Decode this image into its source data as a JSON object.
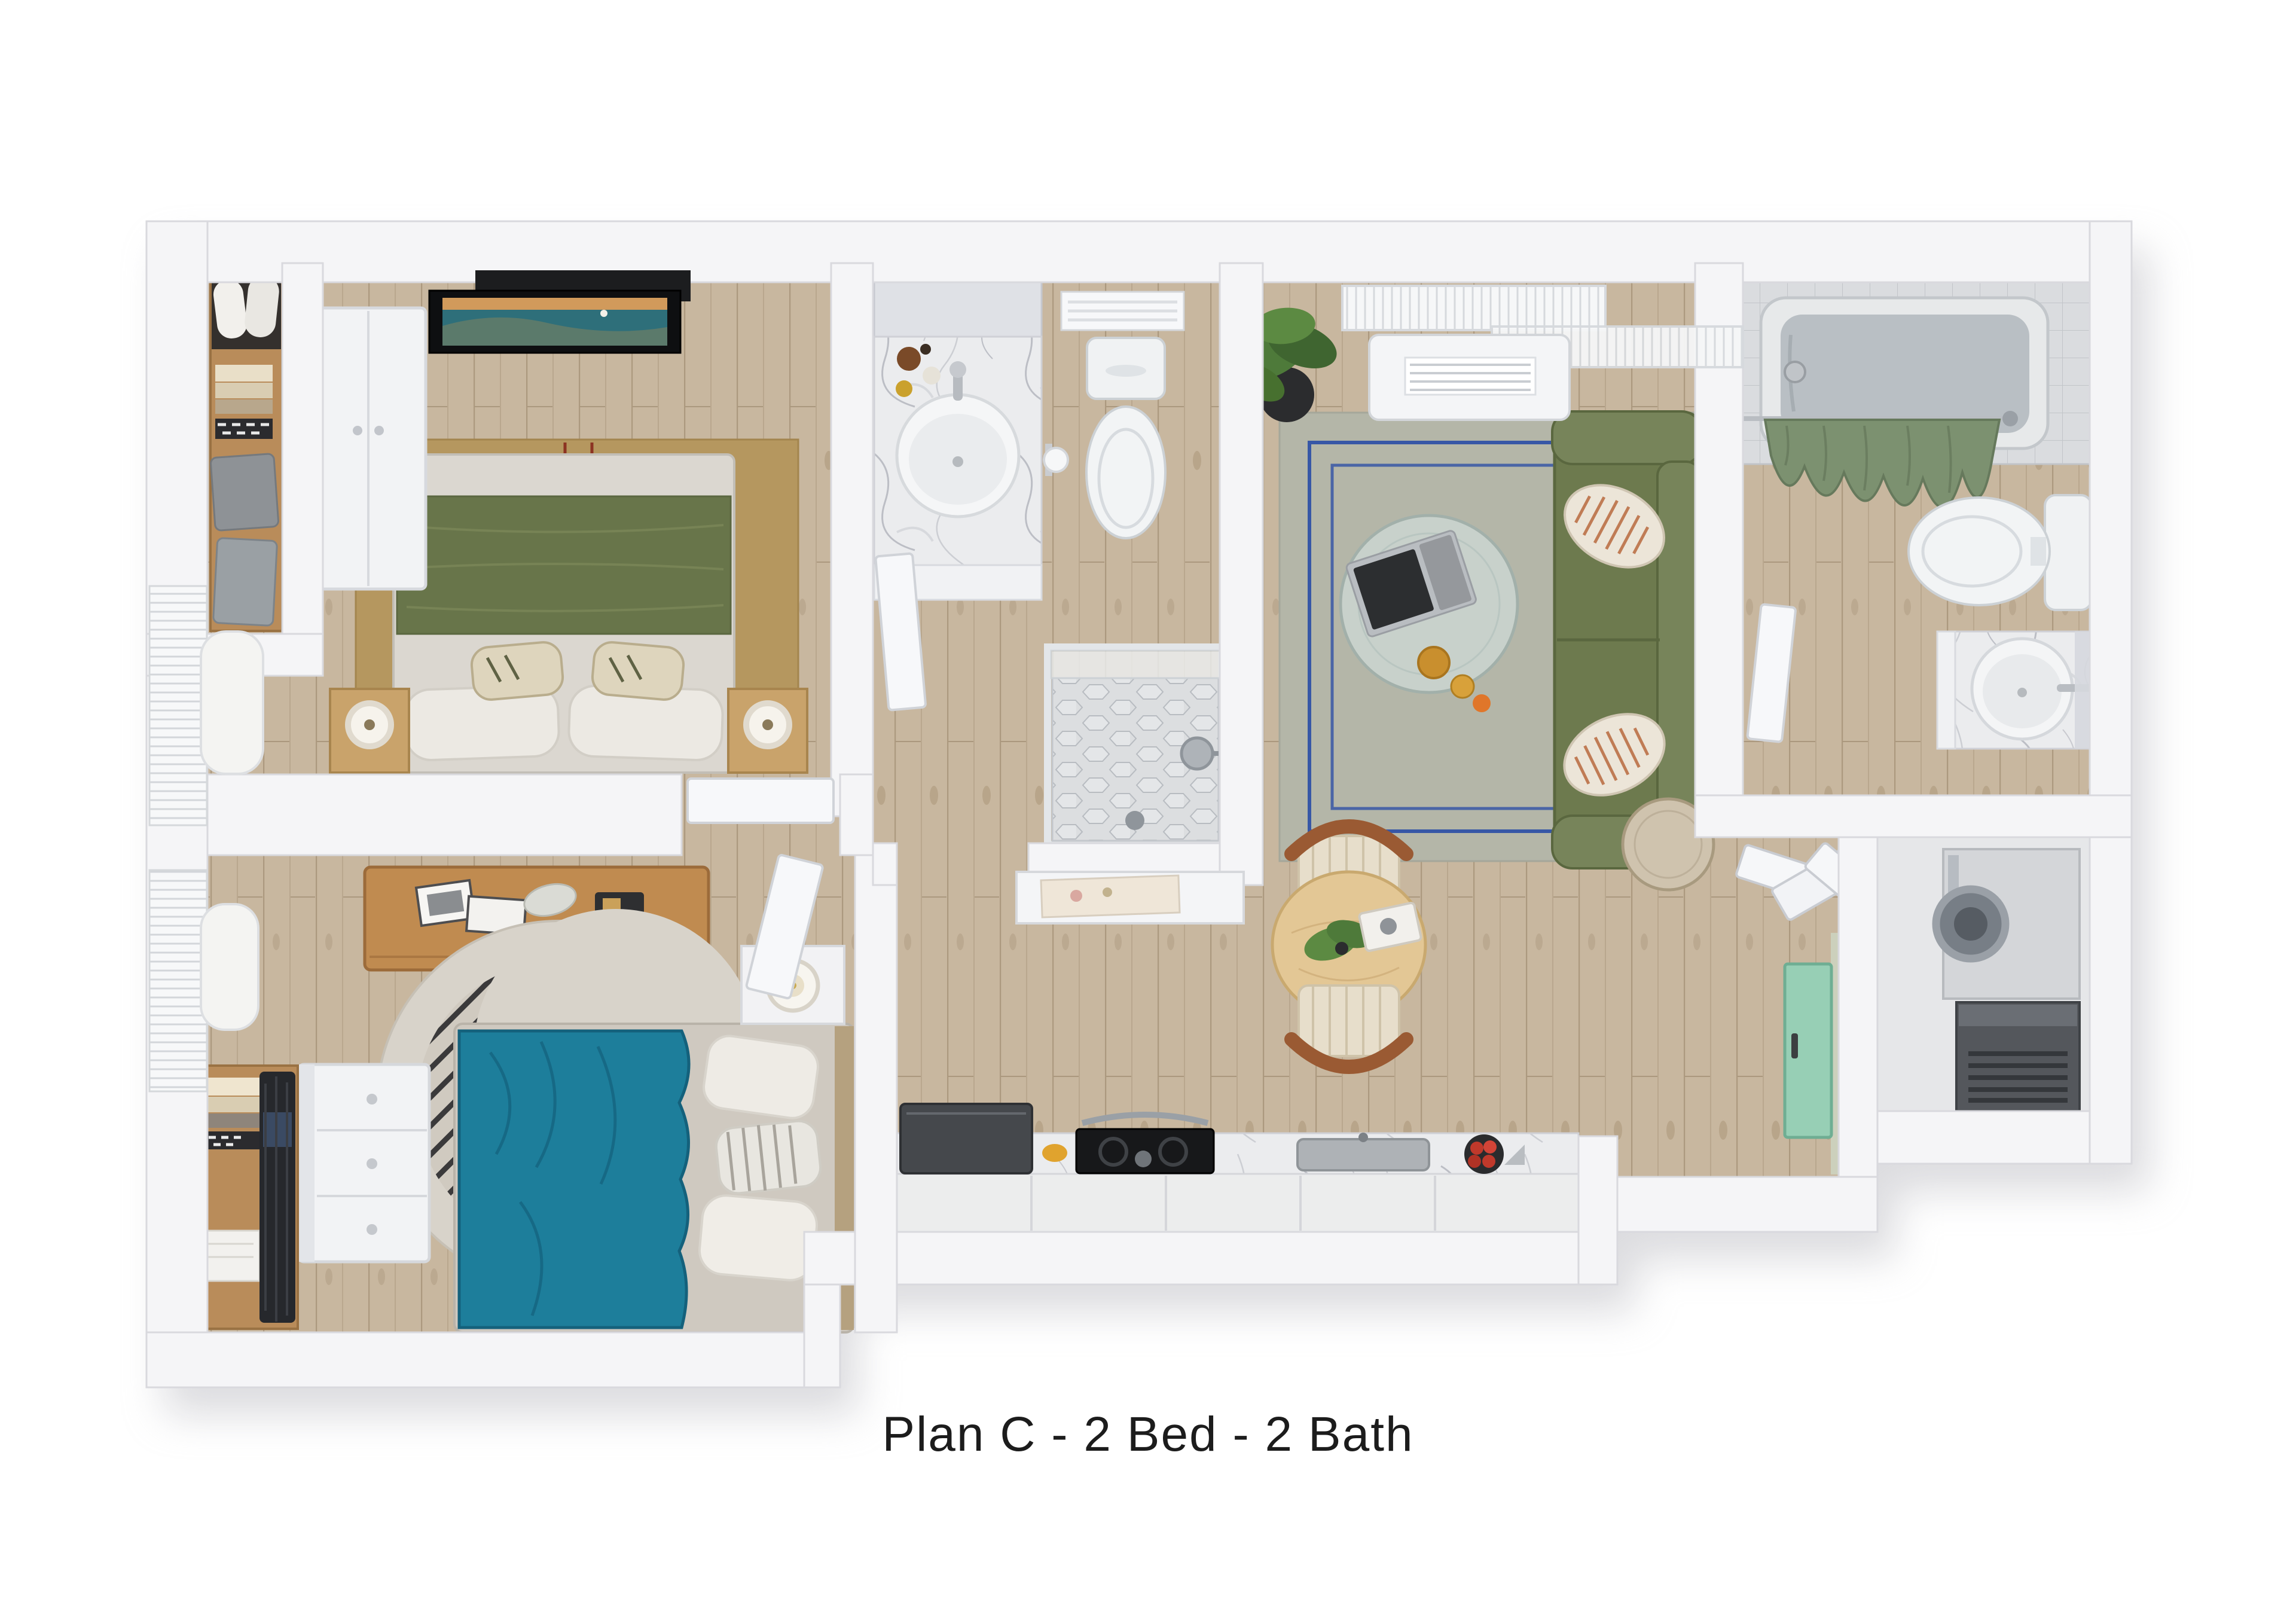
{
  "caption": {
    "text": "Plan C - 2 Bed - 2 Bath"
  },
  "plan": {
    "name": "Plan C",
    "bedrooms": 2,
    "bathrooms": 2,
    "view": "3D top-down furnished floor plan rendering",
    "rooms": [
      {
        "id": "primary-bedroom",
        "furniture": [
          "queen bed with sage green blanket",
          "tan area rug with dark red accent lines",
          "two wood nightstands with ring lamps",
          "wall-mounted TV with coastal image",
          "white wardrobe",
          "reach-in closet with pillows and folded clothes",
          "window blinds on left wall"
        ]
      },
      {
        "id": "bathroom-1",
        "furniture": [
          "marble vanity with round sink and mirror",
          "cosmetic bottles",
          "toilet",
          "toilet-paper holder",
          "wall vent",
          "walk-in shower with hex tile, glass panel, shower head and drain"
        ]
      },
      {
        "id": "living-room",
        "furniture": [
          "green loveseat with two striped pillows",
          "round glass coffee table with laptop and drinks",
          "gray rug with blue double border",
          "potted plant",
          "gallery wall of three green prints",
          "round side table",
          "window blinds",
          "white AC unit"
        ]
      },
      {
        "id": "dining-area",
        "furniture": [
          "round light-wood table",
          "two wood chairs with woven seats",
          "centerpiece plant",
          "serving tray"
        ]
      },
      {
        "id": "kitchen",
        "furniture": [
          "marble counter along bottom wall",
          "dark refrigerator",
          "black range with pots",
          "gray sink",
          "bowl of red tomatoes",
          "yellow dish"
        ]
      },
      {
        "id": "bedroom-2",
        "furniture": [
          "bed with teal duvet and white pillows",
          "round rug with black stripe pattern",
          "wood desk with picture frames",
          "white nightstand with candle",
          "white dresser",
          "closet with shelved clothes",
          "window blinds on left wall"
        ]
      },
      {
        "id": "bathroom-2",
        "furniture": [
          "bathtub with tile surround and green shower curtain",
          "toilet",
          "marble vanity with round sink",
          "mirror",
          "small window"
        ]
      },
      {
        "id": "entry",
        "furniture": [
          "mint-green front door",
          "glowing teal threshold",
          "coat closet with bifold doors"
        ]
      },
      {
        "id": "utility-closet",
        "furniture": [
          "washer/dryer with round silver door",
          "dark mechanical unit with vents"
        ]
      }
    ],
    "palette": {
      "background": "#ffffff",
      "walls": "#f5f5f7",
      "wood_floor": "#c8b79f",
      "sofa_green": "#6d7a4e",
      "blanket_green": "#68754a",
      "duvet_teal": "#1d7e9b",
      "front_door_mint": "#97cfb5",
      "threshold_aqua": "#2fd3c8",
      "shower_curtain_green": "#7c9170",
      "rug_tan": "#b5975f",
      "rug_red_accent": "#8c3322",
      "living_rug_gray": "#b4b6a8",
      "living_rug_blue": "#3757a6",
      "marble": "#ebecee",
      "tile_gray": "#dadcdf",
      "desk_wood": "#c08b50",
      "caption_text": "#1c1c1c"
    }
  }
}
